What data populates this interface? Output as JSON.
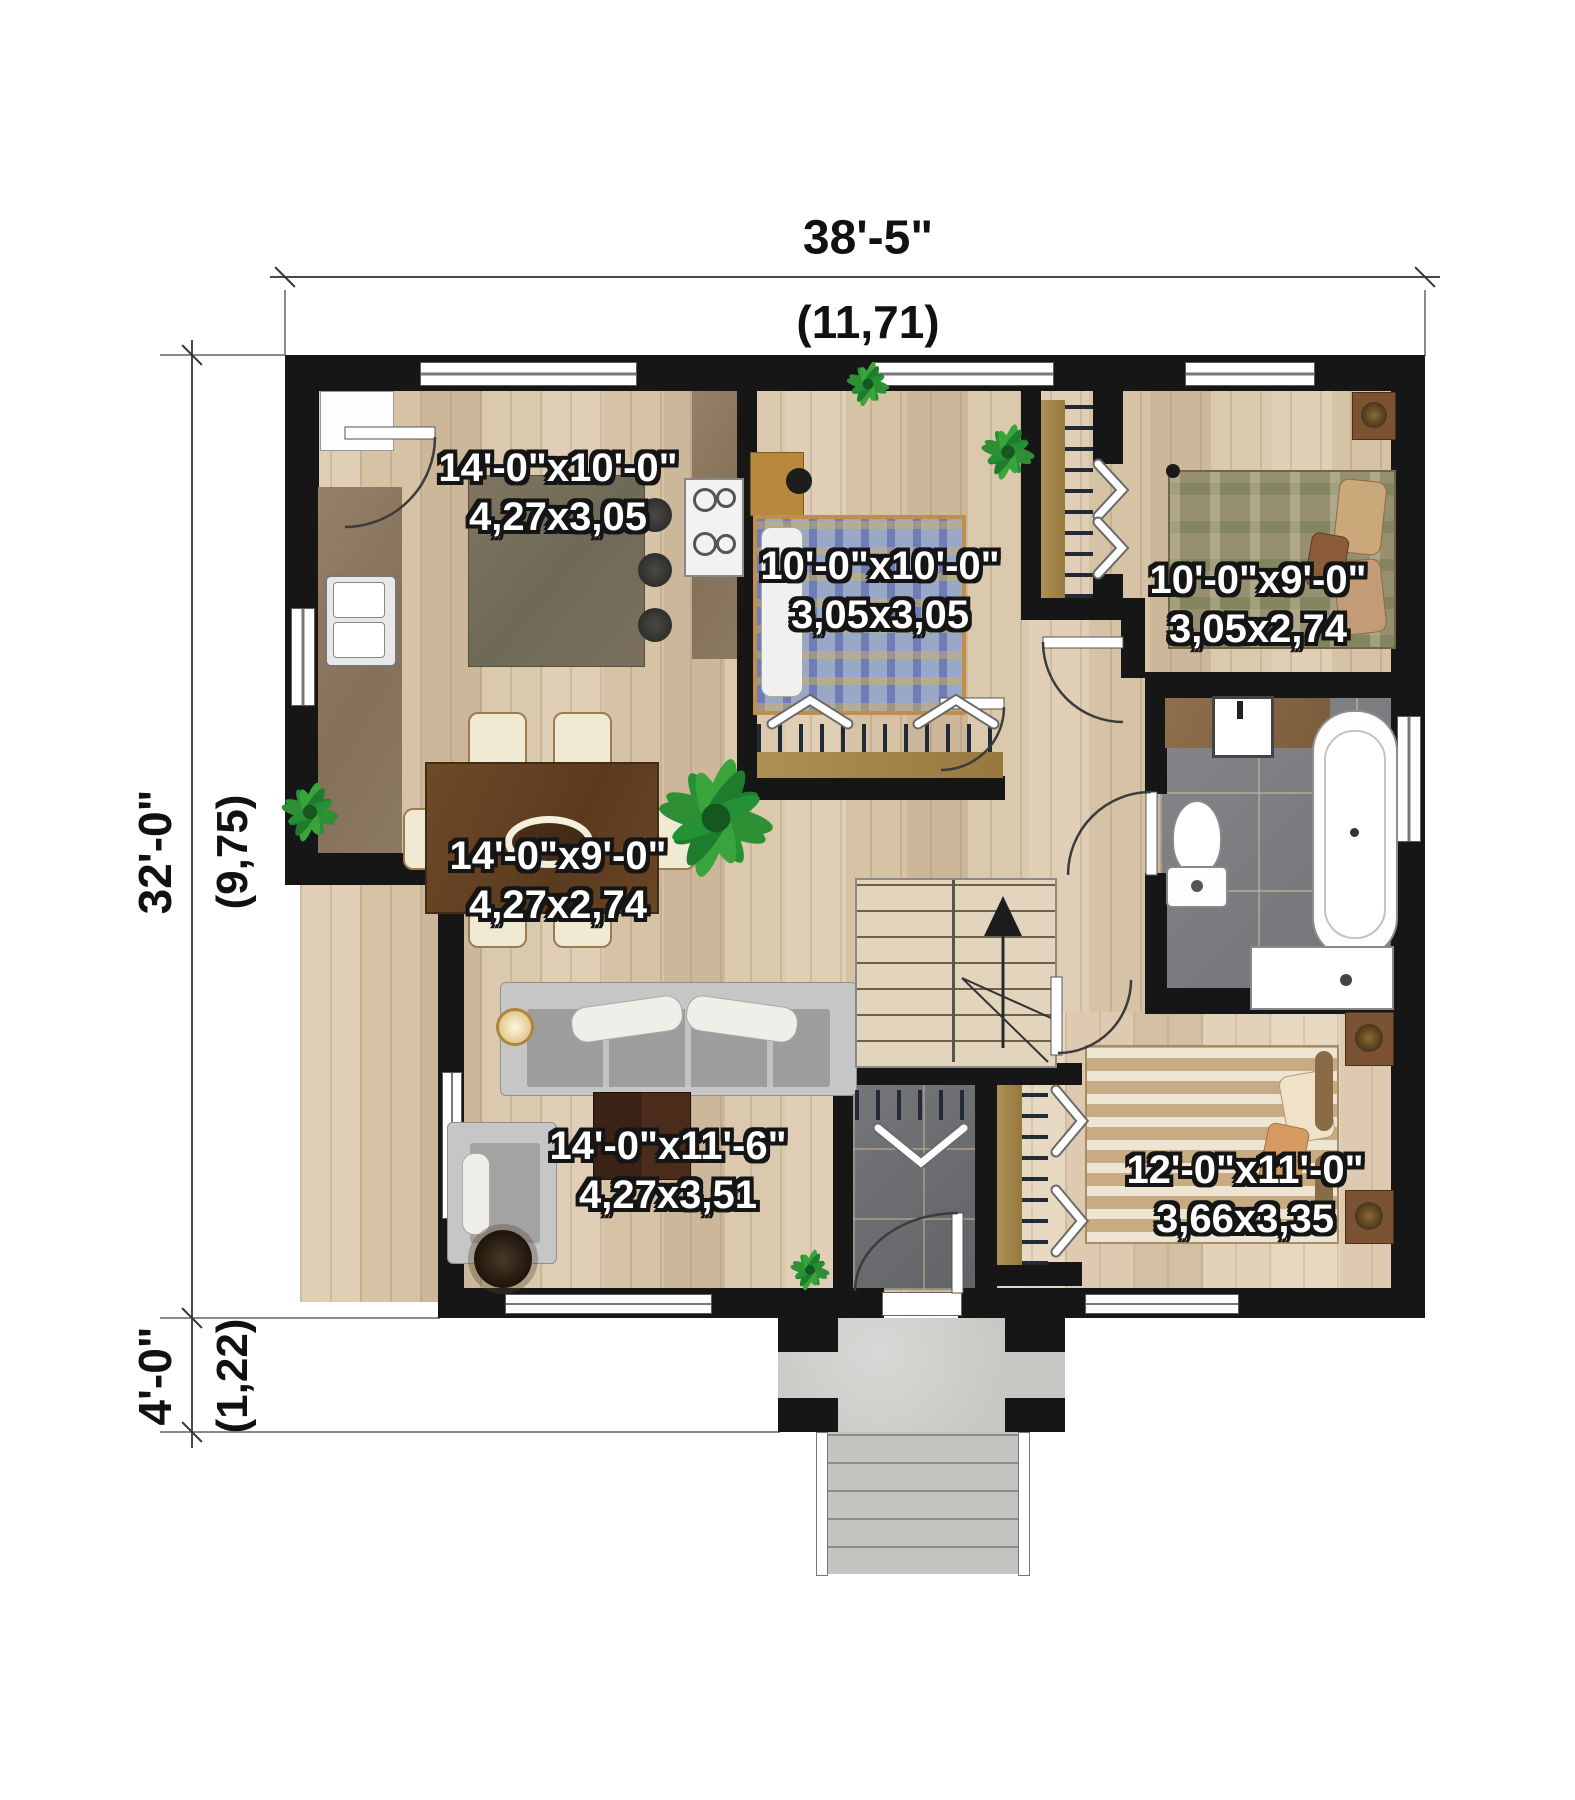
{
  "plan": {
    "overall_width": {
      "imperial": "38'-5\"",
      "metric": "(11,71)"
    },
    "overall_depth": {
      "imperial": "32'-0\"",
      "metric": "(9,75)"
    },
    "porch_depth": {
      "imperial": "4'-0\"",
      "metric": "(1,22)"
    }
  },
  "rooms": {
    "kitchen": {
      "imperial": "14'-0\"x10'-0\"",
      "metric": "4,27x3,05"
    },
    "bedroom_top_middle": {
      "imperial": "10'-0\"x10'-0\"",
      "metric": "3,05x3,05"
    },
    "bedroom_top_right": {
      "imperial": "10'-0\"x9'-0\"",
      "metric": "3,05x2,74"
    },
    "dining": {
      "imperial": "14'-0\"x9'-0\"",
      "metric": "4,27x2,74"
    },
    "living": {
      "imperial": "14'-0\"x11'-6\"",
      "metric": "4,27x3,51"
    },
    "bedroom_bottom_right": {
      "imperial": "12'-0\"x11'-0\"",
      "metric": "3,66x3,35"
    }
  },
  "colors": {
    "wall": "#161616",
    "wood_floor": "#dbc9ae",
    "wood_floor_light": "#e2d2ba",
    "bath_tile": "#7b7d80",
    "entry_tile": "#6c6e71",
    "concrete": "#c7c7c4",
    "counter_brown": "#8c7557",
    "label_text": "#ffffff",
    "label_outline": "#151515",
    "dimension_text": "#111111"
  }
}
